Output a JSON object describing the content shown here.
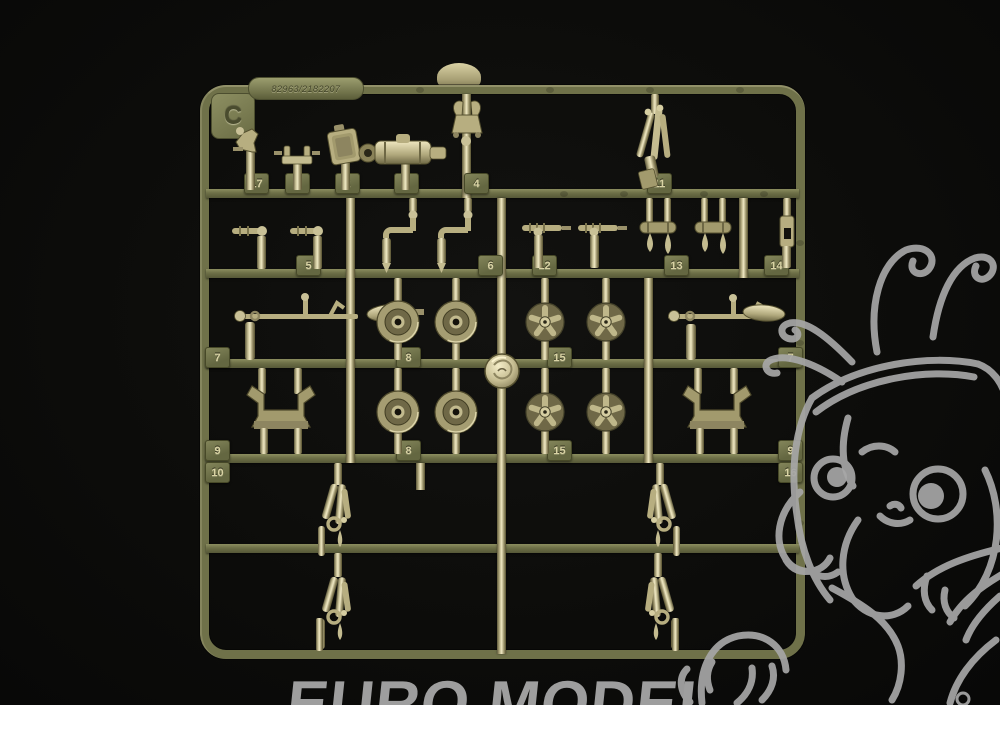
{
  "photo": {
    "subject": "olive plastic model kit sprue on black fabric",
    "background_color": "#0c0c0a",
    "bottom_strip_color": "#ffffff"
  },
  "sprue": {
    "gate_letter": "C",
    "mold_code": "82963/2182207",
    "plastic_color": "#6f7149",
    "shiny_runner_color": "#f0e9c4",
    "part_tags": [
      "17",
      "1",
      "2",
      "3",
      "4",
      "11",
      "5",
      "6",
      "12",
      "13",
      "14",
      "7",
      "8",
      "15",
      "7",
      "9",
      "8",
      "15",
      "9",
      "10",
      "16"
    ]
  },
  "watermark": {
    "text": "EURO MODEL",
    "color": "#9e9e9e",
    "mascot": "dragon-line-art"
  }
}
